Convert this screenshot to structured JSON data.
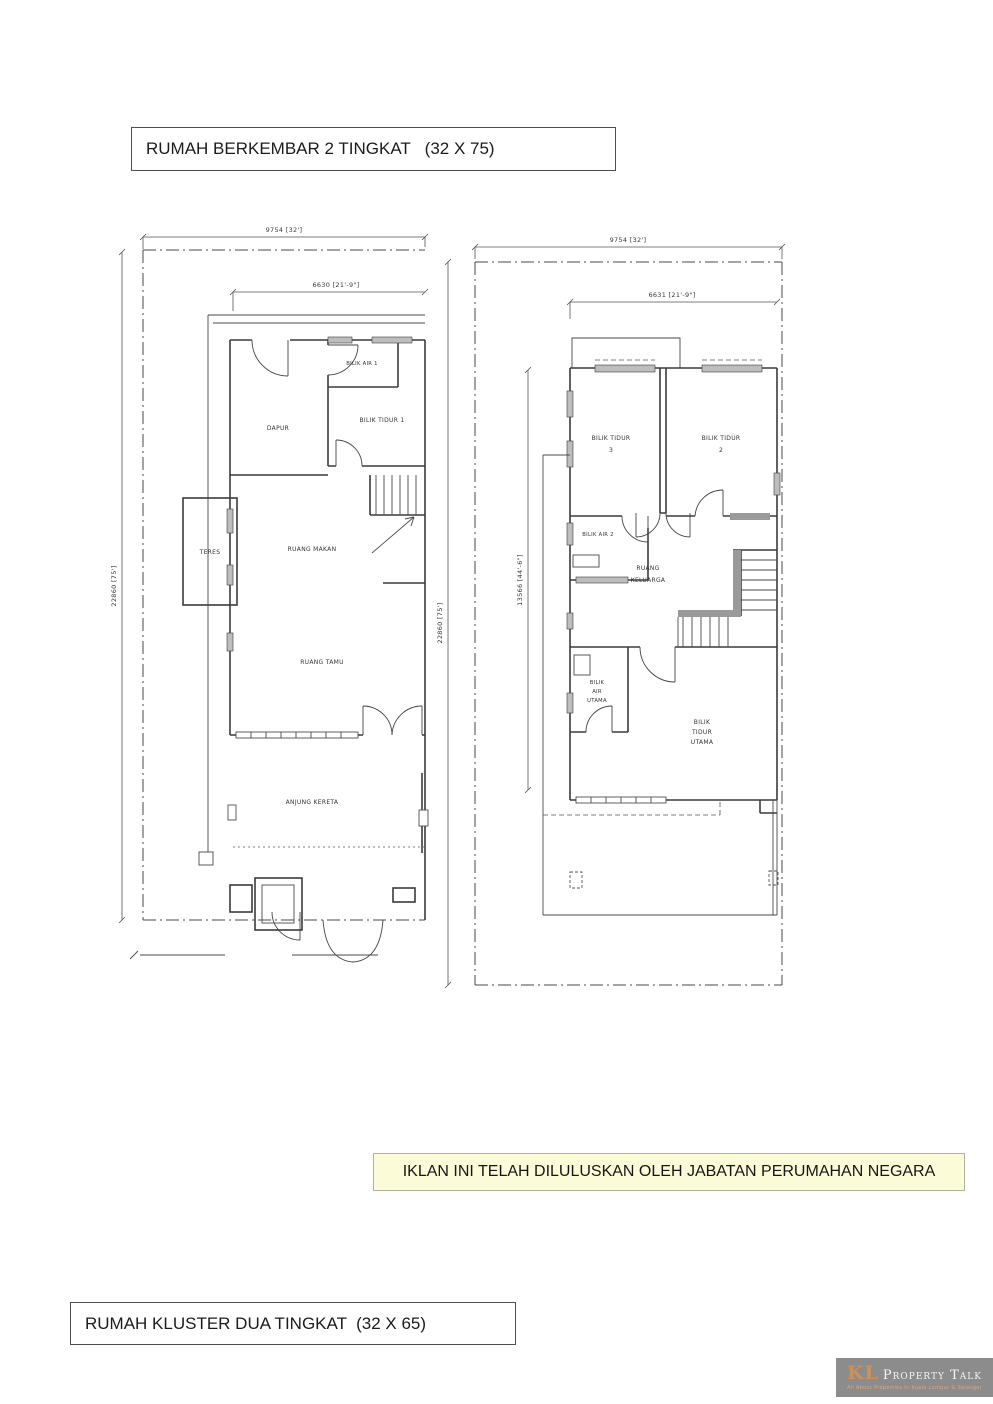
{
  "titles": {
    "top": "RUMAH BERKEMBAR 2 TINGKAT   (32 X 75)",
    "bottom": "RUMAH KLUSTER DUA TINGKAT  (32 X 65)"
  },
  "approval_banner": {
    "text": "IKLAN INI TELAH DILULUSKAN OLEH JABATAN PERUMAHAN NEGARA"
  },
  "logo": {
    "kl": "KL",
    "name": "Property Talk",
    "tagline": "All About Properties In Kuala Lumpur & Selangor"
  },
  "colors": {
    "banner_bg": "#FBFBD8",
    "logo_bg": "#8C8C8C",
    "logo_accent": "#CF9158",
    "plan_line": "#3B3B3B"
  },
  "ground_floor": {
    "dimensions": {
      "lot_width": "9754 [32']",
      "house_width": "6630 [21'-9\"]",
      "lot_depth": "22860 [75']"
    },
    "rooms": {
      "bilik_air_1": "BILIK AIR 1",
      "dapur": "DAPUR",
      "bilik_tidur_1": "BILIK TIDUR 1",
      "teres": "TERES",
      "ruang_makan": "RUANG MAKAN",
      "ruang_tamu": "RUANG TAMU",
      "anjung_kereta": "ANJUNG KERETA"
    }
  },
  "first_floor": {
    "dimensions": {
      "lot_width": "9754 [32']",
      "house_width": "6631 [21'-9\"]",
      "lot_depth": "22860 [75']",
      "house_depth": "13566 [44'-6\"]"
    },
    "rooms": {
      "bilik_tidur_3": [
        "BILIK TIDUR",
        "3"
      ],
      "bilik_tidur_2": [
        "BILIK TIDUR",
        "2"
      ],
      "bilik_air_2": "BILIK AIR 2",
      "ruang_keluarga": [
        "RUANG",
        "KELUARGA"
      ],
      "bilik_air_utama": [
        "BILIK",
        "AIR",
        "UTAMA"
      ],
      "bilik_tidur_utama": [
        "BILIK",
        "TIDUR",
        "UTAMA"
      ]
    }
  }
}
